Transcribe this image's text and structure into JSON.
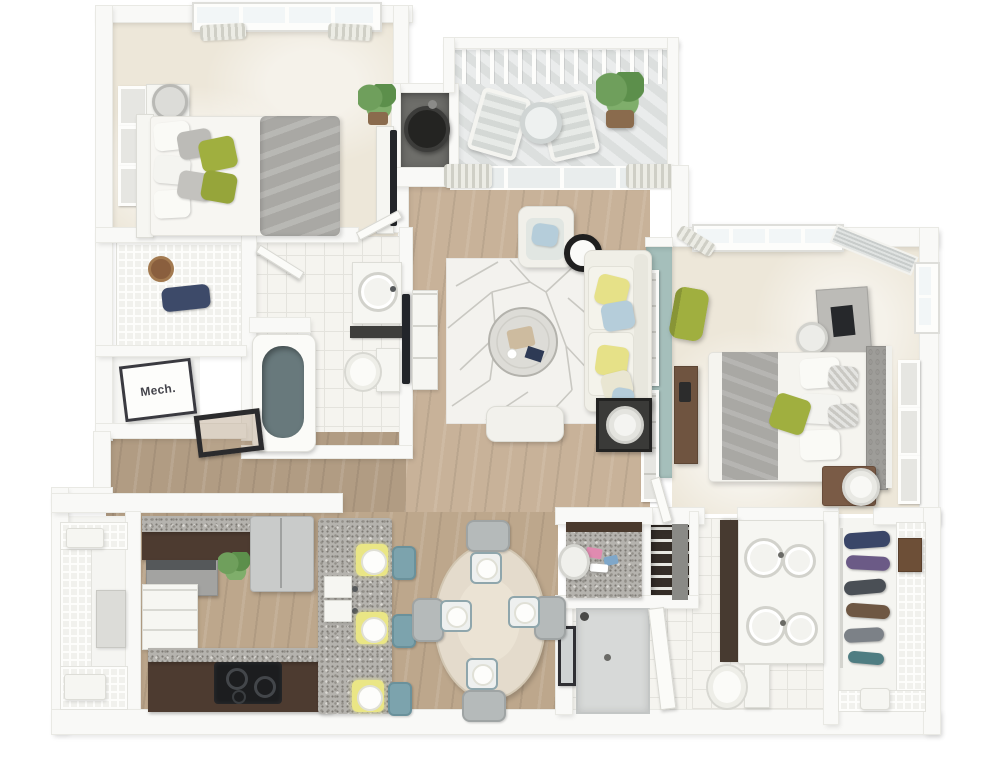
{
  "scene": {
    "kind": "3d-floor-plan-render",
    "view": "top-down",
    "subject": "two-bedroom two-bath apartment with balcony"
  },
  "labels": {
    "mech_room": "Mech."
  },
  "colors": {
    "wall": "#f9f9f7",
    "wood-light": "#c8b299",
    "wood-mid": "#bda78c",
    "wood-dark": "#b19c83",
    "carpet": "#ede7d9",
    "tile": "#f5f4ef",
    "deck-gray": "#e3e6e5",
    "accent-wall": "#a5bfbb",
    "espresso": "#4d3b30",
    "granite": "#b5b3ae",
    "sofa": "#f0efe7",
    "pillow-yellow": "#e6e188",
    "pillow-blue": "#b5cdda",
    "green-accent": "#a0af3f",
    "teal-stool": "#7ca3ad",
    "placemat": "#eae685",
    "duvet-gray": "#a9a8a4",
    "tub-interior": "#68797c",
    "furniture-brown": "#7a5b46"
  },
  "rooms": [
    {
      "id": "bedroom-1"
    },
    {
      "id": "closet-1"
    },
    {
      "id": "mechanical-room"
    },
    {
      "id": "bathroom-1"
    },
    {
      "id": "hallway"
    },
    {
      "id": "balcony"
    },
    {
      "id": "water-heater-closet"
    },
    {
      "id": "living-room"
    },
    {
      "id": "dining-area"
    },
    {
      "id": "kitchen"
    },
    {
      "id": "pantry-closet"
    },
    {
      "id": "master-bedroom"
    },
    {
      "id": "master-bathroom"
    },
    {
      "id": "walk-in-closet"
    },
    {
      "id": "linen-closet"
    },
    {
      "id": "entry"
    }
  ],
  "furniture": {
    "bedroom-1": [
      "bed",
      "green-pillows",
      "gray-duvet",
      "nightstand",
      "lamp",
      "wall-art",
      "plant",
      "dresser",
      "tv",
      "window",
      "curtains"
    ],
    "balcony": [
      "railing",
      "two-chairs",
      "round-table",
      "potted-plant"
    ],
    "living-room": [
      "sofa",
      "armchair",
      "area-rug",
      "round-ottoman-tray",
      "ottoman-bench",
      "tv",
      "media-console",
      "side-table",
      "drum-lamp"
    ],
    "master-bedroom": [
      "bed",
      "tufted-headboard",
      "green-pillow",
      "nightstand",
      "lamp",
      "desk",
      "desk-chair",
      "green-chair",
      "dresser",
      "wall-art",
      "windows"
    ],
    "master-bathroom": [
      "double-vanity",
      "toilet",
      "walk-in-shower",
      "glass-door"
    ],
    "bathroom-1": [
      "bathtub",
      "toilet",
      "vanity-sink"
    ],
    "kitchen": [
      "l-shaped-cabinets",
      "granite-counters",
      "range",
      "cooktop",
      "refrigerator",
      "island",
      "double-sink",
      "three-stools",
      "place-settings",
      "plant"
    ],
    "dining-area": [
      "oval-table",
      "four-chairs",
      "square-plates"
    ],
    "walk-in-closet": [
      "wire-shelving",
      "hanging-clothes",
      "drawer-box",
      "basket"
    ]
  }
}
